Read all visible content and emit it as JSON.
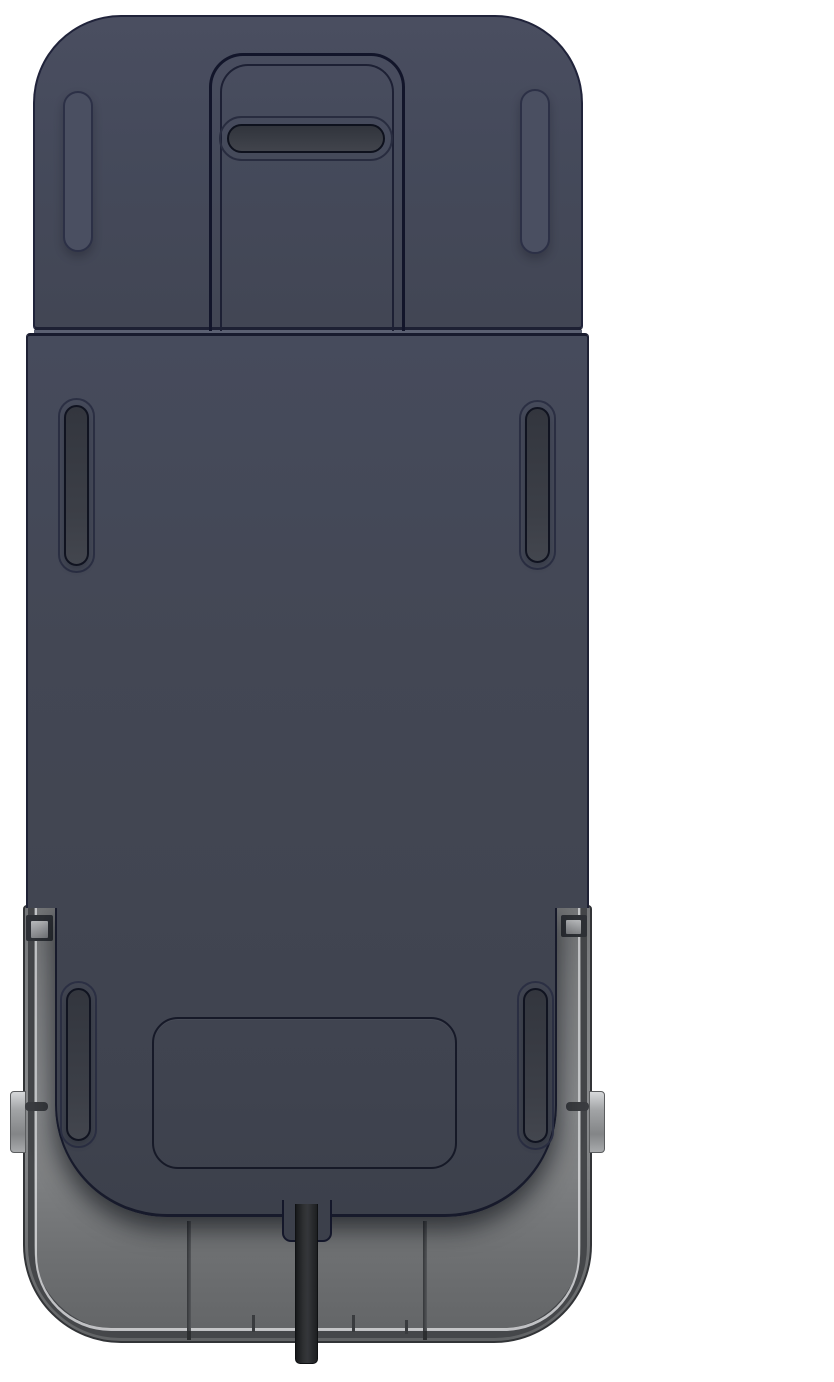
{
  "scene": {
    "type": "3d-product-render",
    "description": "Top-down render of a dark navy rectangular device seated in a light gray dock tray, with a black power cable exiting the bottom center",
    "background_color": "#ffffff"
  },
  "palette": {
    "bg": "#ffffff",
    "navy-base": "#444857",
    "navy-light": "#4a4f61",
    "navy-dark": "#3e4250",
    "outline-dark": "#1a1d30",
    "groove-dark": "#12152a",
    "slot-fill-dark": "#34373f",
    "slot-fill-light": "#43464e",
    "seam-light": "#5b6072",
    "tray-light": "#898b8d",
    "tray-mid": "#7e8082",
    "tray-dark": "#626466",
    "tray-border": "#323437",
    "rim-highlight": "#d6d8da",
    "rim-shadow": "#45474a",
    "clip-dark": "#2f3237",
    "clip-inner": "#85878a",
    "tab-light": "#d6d8da",
    "tab-mid": "#8f9193",
    "pin-dark": "#3b3d41",
    "cable-dark": "#17191b",
    "cable-mid": "#333537"
  },
  "parts": {
    "tray": {
      "label": "gray dock tray with rounded bottom corners and inner rim lines"
    },
    "tray_rib_left": {
      "label": "tray floor seam rib (left)"
    },
    "tray_rib_right": {
      "label": "tray floor seam rib (right)"
    },
    "tray_clip_left": {
      "label": "tray retaining clip (left)"
    },
    "tray_clip_right": {
      "label": "tray retaining clip (right)"
    },
    "side_tab_left": {
      "label": "side release tab (left)"
    },
    "side_tab_right": {
      "label": "side release tab (right)"
    },
    "body": {
      "label": "navy device main body"
    },
    "head": {
      "label": "navy top cover section with rounded corners"
    },
    "head_notch": {
      "label": "recessed groove panel at top center"
    },
    "handle_slot": {
      "label": "horizontal handle slot"
    },
    "head_pill_left": {
      "label": "raised pill detail (top left)"
    },
    "head_pill_right": {
      "label": "raised pill detail (top right)"
    },
    "seam": {
      "label": "seam between top cover and body"
    },
    "upper_slot_left": {
      "label": "vertical vent slot (upper left)"
    },
    "upper_slot_right": {
      "label": "vertical vent slot (upper right)"
    },
    "lower_slot_left": {
      "label": "vertical vent slot (lower left)"
    },
    "lower_slot_right": {
      "label": "vertical vent slot (lower right)"
    },
    "bottom_panel": {
      "label": "rounded access panel outline near bottom"
    },
    "cable": {
      "label": "black power cable exiting bottom center"
    }
  }
}
